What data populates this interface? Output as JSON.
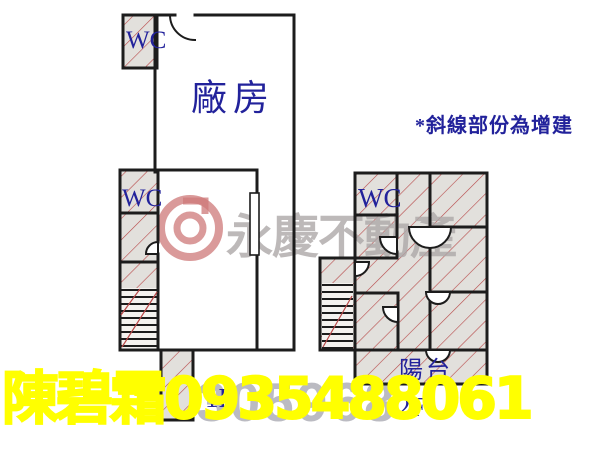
{
  "plan": {
    "note": "*斜線部份為增建",
    "wc_label": "WC",
    "left_plan": {
      "factory_label": "廠房",
      "floor_label": "1F"
    },
    "right_plan": {
      "balcony_label": "陽台",
      "floor_label": "2F"
    },
    "watermark": {
      "brand": "永慶不動產",
      "listing_number": "305968"
    },
    "contact": "陳碧霜0935488061",
    "colors": {
      "label_navy": "#22229b",
      "hatch_red": "#b84848",
      "hatch_grey": "#e2e0dc",
      "wall_black": "#1c1c1c",
      "contact_yellow": "#ffff00",
      "watermark_grey": "#aca7a7"
    }
  }
}
